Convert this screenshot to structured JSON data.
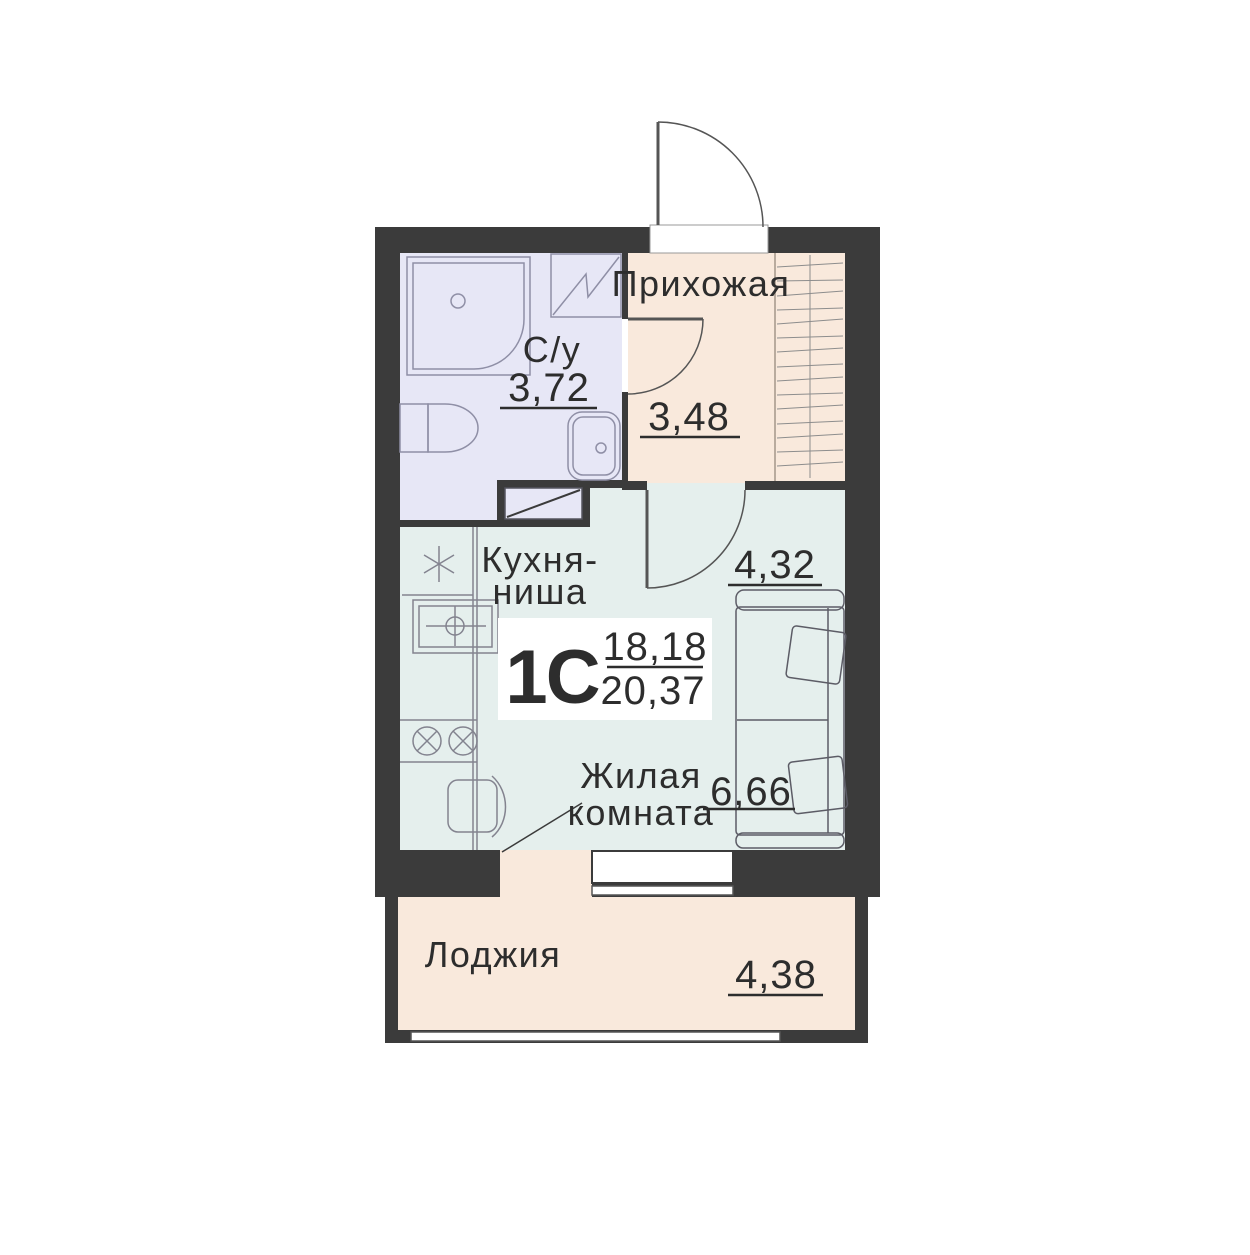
{
  "apartment": {
    "type": "1С",
    "living_area": "18,18",
    "total_area": "20,37"
  },
  "rooms": {
    "hallway": {
      "label": "Прихожая",
      "area": "3,48"
    },
    "bathroom": {
      "label": "С/у",
      "area": "3,72"
    },
    "kitchen": {
      "label_line_1": "Кухня-",
      "label_line_2": "ниша"
    },
    "living_room": {
      "label_line_1": "Жилая",
      "label_line_2": "комната",
      "dim_top": "4,32",
      "dim_bottom": "6,66"
    },
    "loggia": {
      "label": "Лоджия",
      "area": "4,38"
    }
  },
  "colors": {
    "wall": "#3b3b3b",
    "bathroom_floor": "#e7e7f6",
    "hallway_floor": "#f9e9dc",
    "living_floor": "#e5efed",
    "loggia_floor": "#f9e9dc",
    "text": "#2d2d2d"
  }
}
